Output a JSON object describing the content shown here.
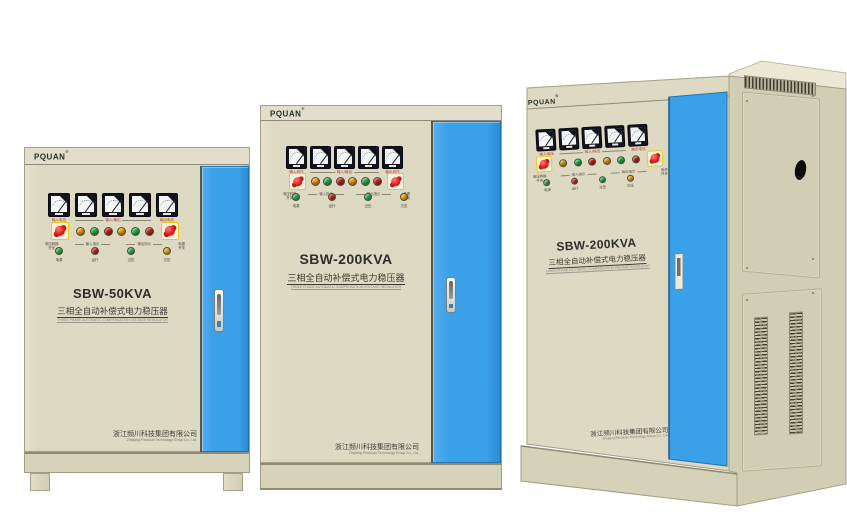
{
  "brand": {
    "logo_text": "PQUAN",
    "registered_mark": "®"
  },
  "colors": {
    "door_blue": "#3aa0e8",
    "cabinet_beige": "#ded9c2",
    "knob_red": "#e01f1f",
    "knob_frame_yellow": "#eecb10",
    "pilot_lights": [
      "#f59b00",
      "#22b24c",
      "#c9201c",
      "#f59b00",
      "#22b24c",
      "#c9201c"
    ],
    "indicator_lights": [
      "#22b24c",
      "#c9201c",
      "#22b24c",
      "#f5a800"
    ]
  },
  "panel_labels": {
    "meter_left": "输入电压",
    "meter_group": "输入/输出",
    "meter_right": "输出电压",
    "knob_left": "电压转换\n开关",
    "group_left": "输入指示",
    "group_right": "输出指示",
    "knob_right": "电源\n开关",
    "indicator_labels": [
      "电源",
      "运行",
      "过压",
      "欠压"
    ]
  },
  "cabinets": {
    "left": {
      "model": "SBW-50KVA",
      "subtitle_cn": "三相全自动补偿式电力稳压器",
      "subtitle_en": "THREE PHASE AUTOMATIC COMPENSATION VOLTAGE REGULATOR",
      "company_cn": "浙江频川科技集团有限公司",
      "company_en": "Zhejiang Pinchuan Technology Group Co., Ltd."
    },
    "middle": {
      "model": "SBW-200KVA",
      "subtitle_cn": "三相全自动补偿式电力稳压器",
      "subtitle_en": "THREE PHASE AUTOMATIC COMPENSATION VOLTAGE REGULATOR",
      "company_cn": "浙江频川科技集团有限公司",
      "company_en": "Zhejiang Pinchuan Technology Group Co., Ltd."
    },
    "right": {
      "model": "SBW-200KVA",
      "subtitle_cn": "三相全自动补偿式电力稳压器",
      "subtitle_en": "THREE PHASE AUTOMATIC COMPENSATION VOLTAGE REGULATOR",
      "company_cn": "浙江频川科技集团有限公司",
      "company_en": "Zhejiang Pinchuan Technology Group Co., Ltd."
    }
  }
}
